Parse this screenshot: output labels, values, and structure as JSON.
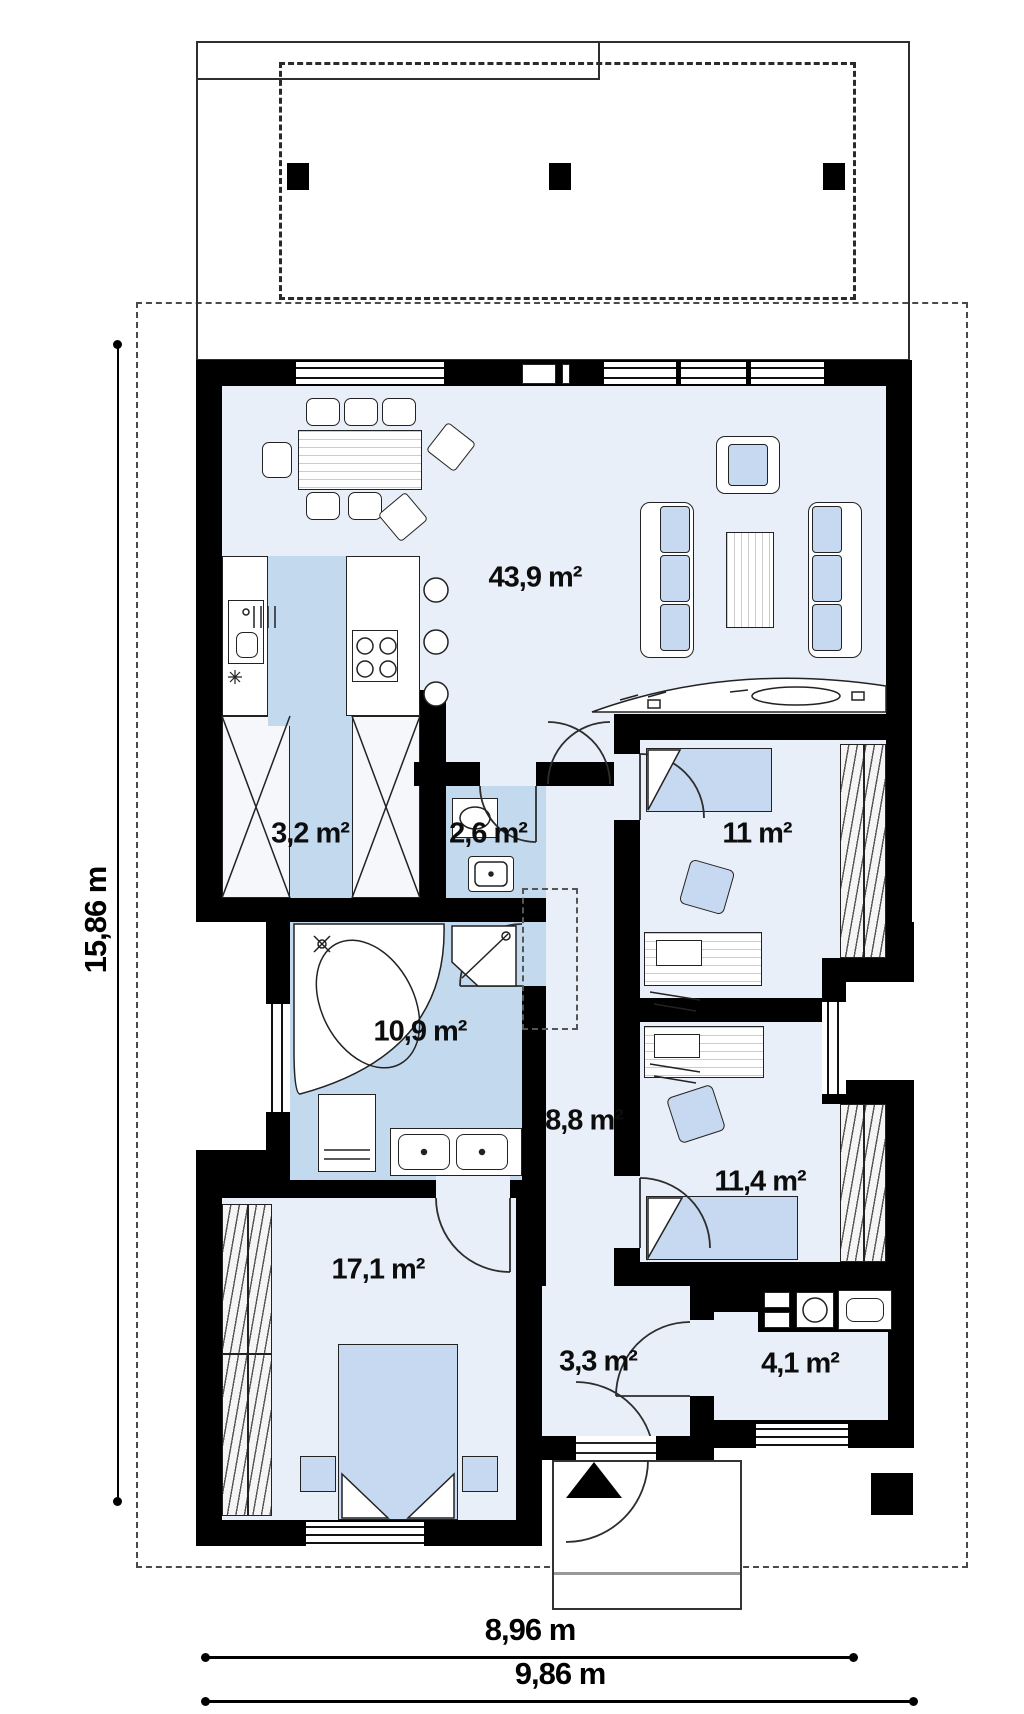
{
  "plan_title": "single-storey house floor plan",
  "rooms": {
    "living": {
      "label": "43,9 m²"
    },
    "wardrobe": {
      "label": "3,2 m²"
    },
    "wc": {
      "label": "2,6 m²"
    },
    "bedroom_top": {
      "label": "11 m²"
    },
    "bathroom": {
      "label": "10,9 m²"
    },
    "hall": {
      "label": "8,8 m²"
    },
    "bedroom_right": {
      "label": "11,4 m²"
    },
    "bedroom_left": {
      "label": "17,1 m²"
    },
    "entry": {
      "label": "3,3 m²"
    },
    "utility": {
      "label": "4,1 m²"
    }
  },
  "dimensions": {
    "left_total": "15,86 m",
    "bottom_inner": "8,96 m",
    "bottom_outer": "9,86 m"
  },
  "colors": {
    "wall": "#000000",
    "floor_light": "#e9eff8",
    "floor_blue": "#c3d9ee",
    "furniture_blue": "#c6d9f0"
  }
}
